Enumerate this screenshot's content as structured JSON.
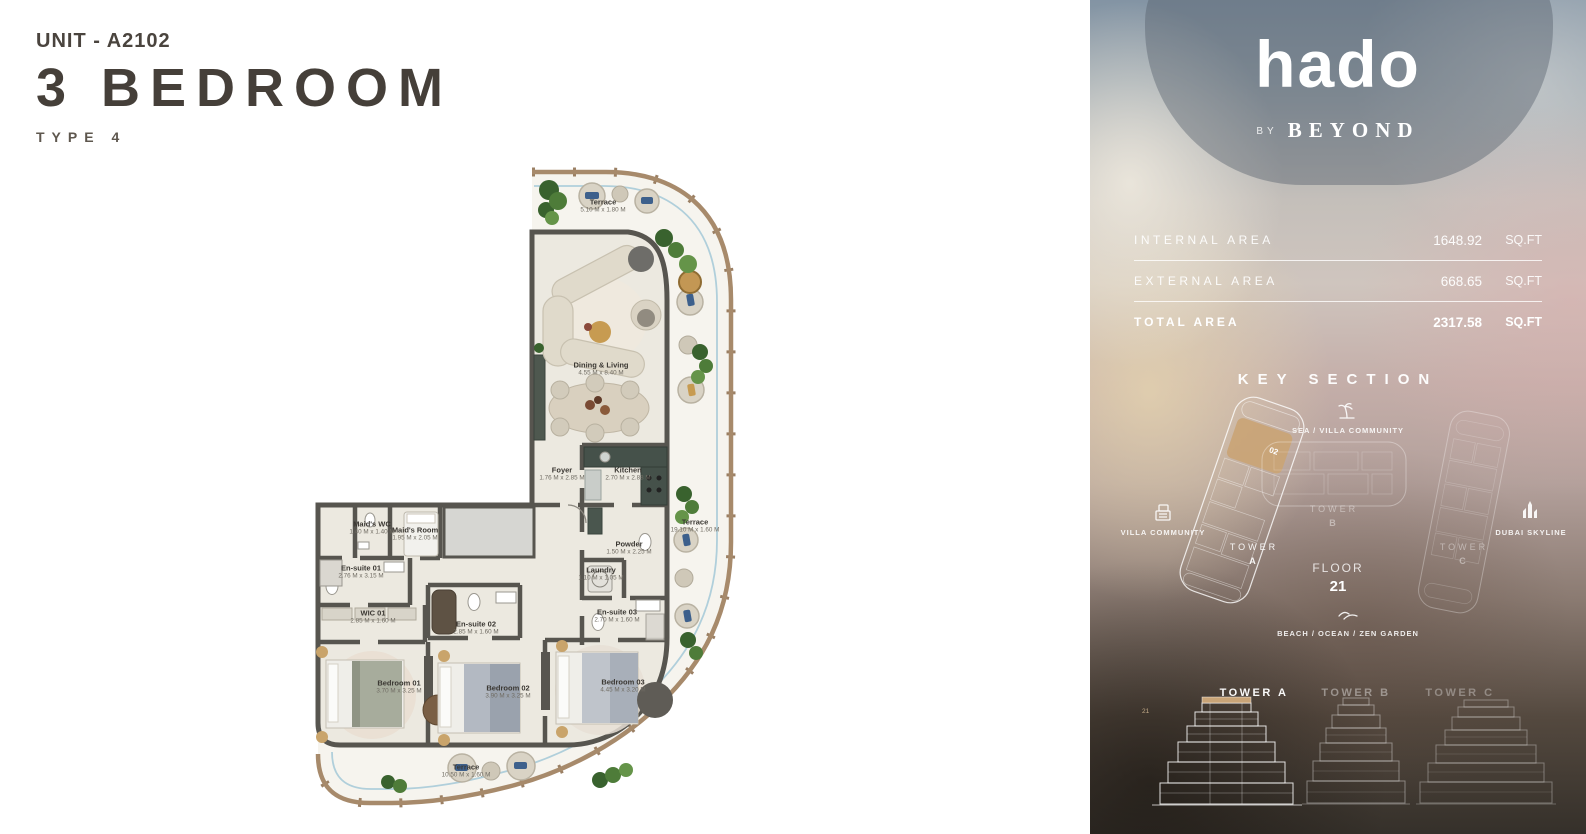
{
  "header": {
    "unit_label": "UNIT - A2102",
    "title": "3 BEDROOM",
    "type_label": "TYPE 4"
  },
  "plan": {
    "rooms": [
      {
        "name": "Terrace",
        "dims": "5.10 M x 1.80 M"
      },
      {
        "name": "Dining & Living",
        "dims": "4.55 M x 8.40 M"
      },
      {
        "name": "Foyer",
        "dims": "1.76 M x 2.85 M"
      },
      {
        "name": "Kitchen",
        "dims": "2.70 M x 2.88 M"
      },
      {
        "name": "Terrace",
        "dims": "19.10 M x 1.60 M"
      },
      {
        "name": "Maid's WC",
        "dims": "1.40 M x 1.40 M"
      },
      {
        "name": "Maid's Room",
        "dims": "1.95 M x 2.05 M"
      },
      {
        "name": "En-suite 01",
        "dims": "2.76 M x 3.15 M"
      },
      {
        "name": "WIC 01",
        "dims": "2.85 M x 1.60 M"
      },
      {
        "name": "En-suite 02",
        "dims": "2.85 M x 1.60 M"
      },
      {
        "name": "Powder",
        "dims": "1.50 M x 2.25 M"
      },
      {
        "name": "Laundry",
        "dims": "1.10 M x 1.05 M"
      },
      {
        "name": "En-suite 03",
        "dims": "2.70 M x 1.60 M"
      },
      {
        "name": "Bedroom 01",
        "dims": "3.70 M x 3.25 M"
      },
      {
        "name": "Bedroom 02",
        "dims": "3.90 M x 3.25 M"
      },
      {
        "name": "Bedroom 03",
        "dims": "4.45 M x 3.20 M"
      },
      {
        "name": "Terrace",
        "dims": "10.50 M x 1.60 M"
      }
    ]
  },
  "panel": {
    "brand": {
      "logo": "hado",
      "by_label": "BY",
      "name": "BEYOND"
    },
    "areas": {
      "internal": {
        "label": "INTERNAL AREA",
        "value": "1648.92",
        "unit": "SQ.FT"
      },
      "external": {
        "label": "EXTERNAL AREA",
        "value": "668.65",
        "unit": "SQ.FT"
      },
      "total": {
        "label": "TOTAL AREA",
        "value": "2317.58",
        "unit": "SQ.FT"
      }
    },
    "key_section": {
      "title": "KEY SECTION",
      "sea_label": "SEA / VILLA COMMUNITY",
      "villa_label": "VILLA COMMUNITY",
      "skyline_label": "DUBAI SKYLINE",
      "beach_label": "BEACH / OCEAN / ZEN GARDEN",
      "floor_label": "FLOOR",
      "floor_value": "21",
      "unit_number": "02",
      "tower_a": {
        "line1": "TOWER",
        "line2": "A"
      },
      "tower_b": {
        "line1": "TOWER",
        "line2": "B"
      },
      "tower_c": {
        "line1": "TOWER",
        "line2": "C"
      }
    },
    "elevations": {
      "tower_a": "TOWER A",
      "tower_b": "TOWER B",
      "tower_c": "TOWER C",
      "floor_marker": "21"
    }
  },
  "colors": {
    "accent_tan": "#C9A477",
    "wall": "#57554F",
    "terrace_wall": "#A78A6B",
    "title_text": "#47413C",
    "balustrade_blue": "#A9CBD8"
  }
}
